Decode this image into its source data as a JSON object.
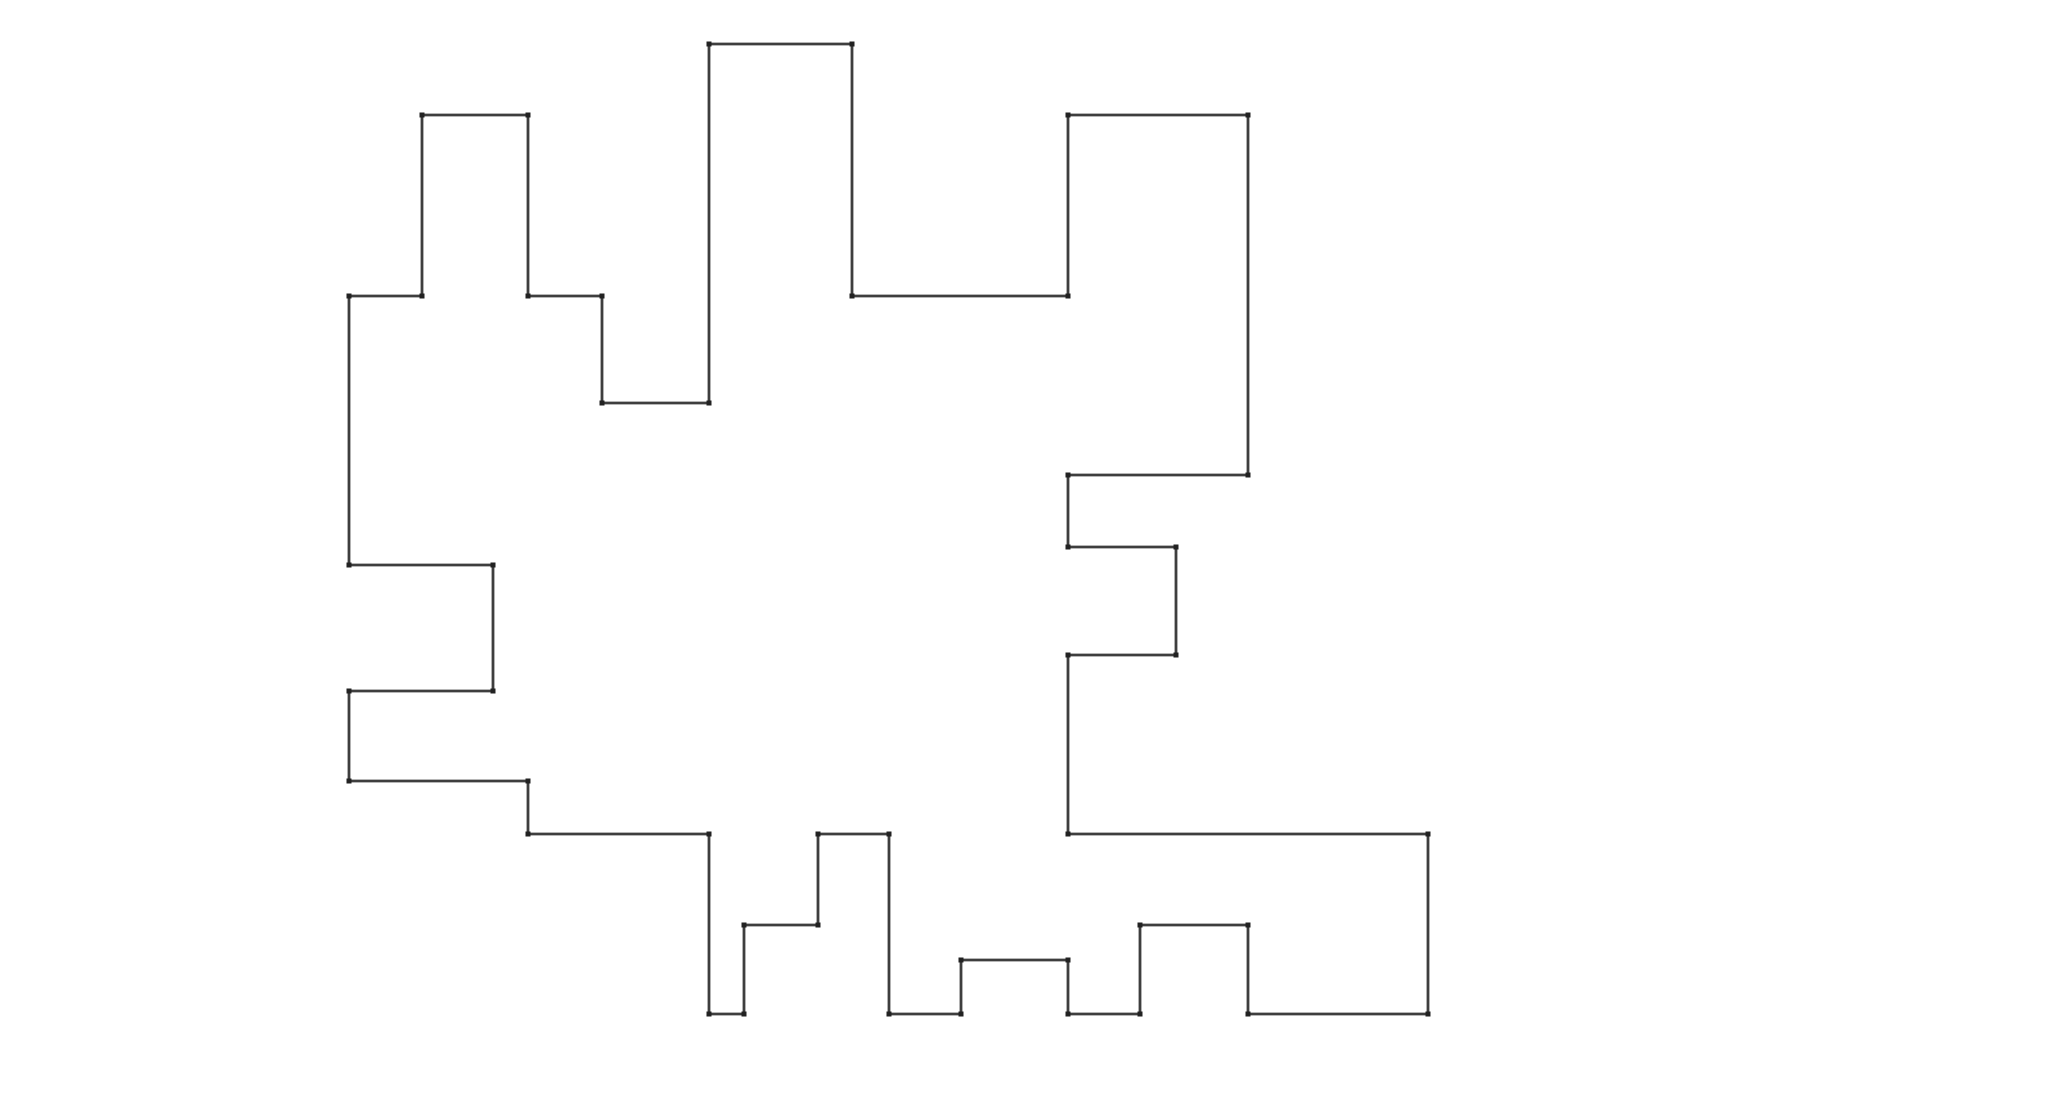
{
  "figure": {
    "kind": "rectilinear-polygon-outline",
    "background_color": "#ffffff",
    "stroke_color": "#3e3e3e",
    "stroke_width": 2.8,
    "fill_color": "#ffffff",
    "vertex_marker_color": "#222222",
    "vertex_marker_size": 5,
    "canvas": {
      "width": 2048,
      "height": 1107
    },
    "vertices": [
      [
        349,
        296
      ],
      [
        422,
        296
      ],
      [
        422,
        115
      ],
      [
        528,
        115
      ],
      [
        528,
        296
      ],
      [
        602,
        296
      ],
      [
        602,
        403
      ],
      [
        709,
        403
      ],
      [
        709,
        44
      ],
      [
        852,
        44
      ],
      [
        852,
        296
      ],
      [
        1068,
        296
      ],
      [
        1068,
        115
      ],
      [
        1248,
        115
      ],
      [
        1248,
        475
      ],
      [
        1068,
        475
      ],
      [
        1068,
        547
      ],
      [
        1176,
        547
      ],
      [
        1176,
        655
      ],
      [
        1068,
        655
      ],
      [
        1068,
        834
      ],
      [
        1428,
        834
      ],
      [
        1428,
        1014
      ],
      [
        1248,
        1014
      ],
      [
        1248,
        925
      ],
      [
        1140,
        925
      ],
      [
        1140,
        1014
      ],
      [
        1068,
        1014
      ],
      [
        1068,
        960
      ],
      [
        961,
        960
      ],
      [
        961,
        1014
      ],
      [
        889,
        1014
      ],
      [
        889,
        834
      ],
      [
        818,
        834
      ],
      [
        818,
        925
      ],
      [
        744,
        925
      ],
      [
        744,
        1014
      ],
      [
        709,
        1014
      ],
      [
        709,
        834
      ],
      [
        528,
        834
      ],
      [
        528,
        781
      ],
      [
        349,
        781
      ],
      [
        349,
        691
      ],
      [
        493,
        691
      ],
      [
        493,
        565
      ],
      [
        349,
        565
      ]
    ]
  }
}
